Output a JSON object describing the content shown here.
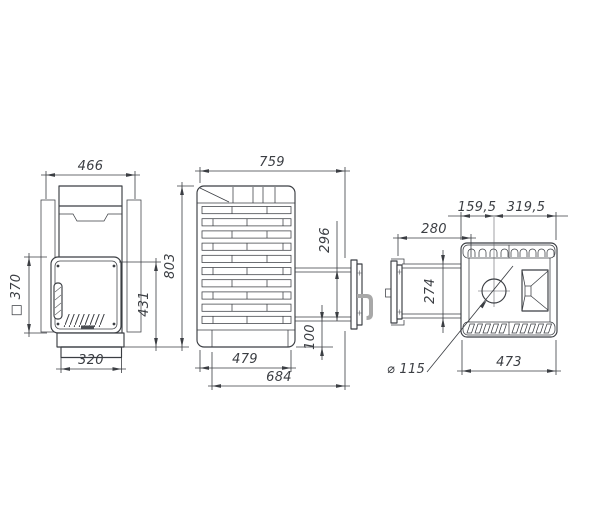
{
  "drawing": {
    "front": {
      "overall_width": "466",
      "firebox_opening": "□ 370",
      "door_height": "431",
      "base_width": "320"
    },
    "side": {
      "overall_depth": "759",
      "overall_height": "803",
      "tunnel_height": "296",
      "tunnel_bottom_offset": "100",
      "body_depth": "479",
      "depth_to_frame": "684"
    },
    "top": {
      "chimney_offset_front": "159,5",
      "chimney_offset_back": "319,5",
      "tunnel_length": "280",
      "tunnel_width": "274",
      "body_width": "473",
      "chimney_diameter": "⌀ 115"
    }
  }
}
